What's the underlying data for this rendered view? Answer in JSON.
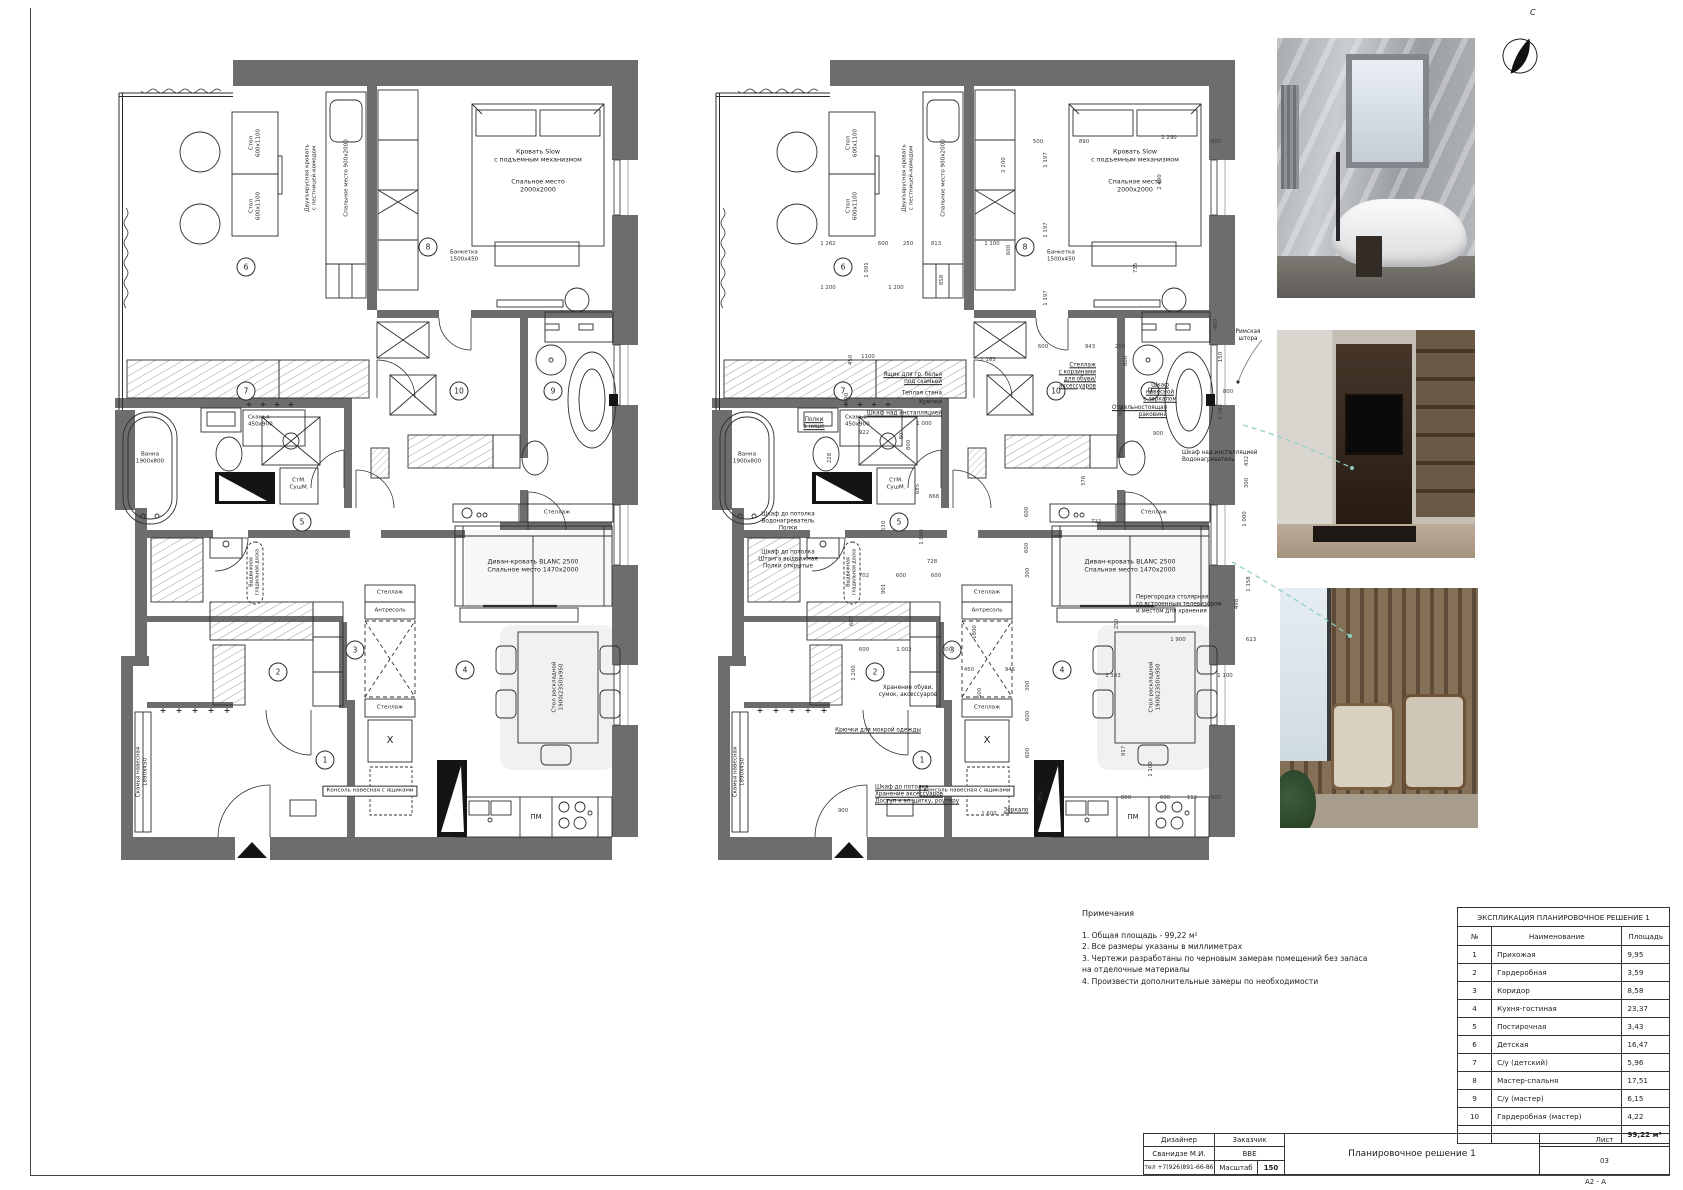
{
  "sheet": {
    "north_letter": "С",
    "format_label": "A2 - A"
  },
  "notes": {
    "title": "Примечания",
    "lines": [
      "1. Общая площадь - 99,22 м²",
      "2. Все размеры указаны в миллиметрах",
      "3. Чертежи разработаны по черновым замерам помещений без запаса",
      "на отделочные материалы",
      "4. Произвести дополнительные замеры по необходимости"
    ]
  },
  "legend": {
    "title": "ЭКСПЛИКАЦИЯ ПЛАНИРОВОЧНОЕ РЕШЕНИЕ 1",
    "col_num": "№",
    "col_name": "Наименование",
    "col_area": "Площадь",
    "rows": [
      {
        "num": "1",
        "name": "Прихожая",
        "area": "9,95"
      },
      {
        "num": "2",
        "name": "Гардеробная",
        "area": "3,59"
      },
      {
        "num": "3",
        "name": "Коридор",
        "area": "8,58"
      },
      {
        "num": "4",
        "name": "Кухня-гостиная",
        "area": "23,37"
      },
      {
        "num": "5",
        "name": "Постирочная",
        "area": "3,43"
      },
      {
        "num": "6",
        "name": "Детская",
        "area": "16,47"
      },
      {
        "num": "7",
        "name": "С/у (детский)",
        "area": "5,96"
      },
      {
        "num": "8",
        "name": "Мастер-спальня",
        "area": "17,51"
      },
      {
        "num": "9",
        "name": "С/у (мастер)",
        "area": "6,15"
      },
      {
        "num": "10",
        "name": "Гардеробная (мастер)",
        "area": "4,22"
      }
    ],
    "total": "99,22 м²"
  },
  "title_block": {
    "designer_label": "Дизайнер",
    "designer": "Сванидзе М.И.",
    "phone": "тел +7(926)891-66-86",
    "client_label": "Заказчик",
    "client": "ВВЕ",
    "scale_label": "Масштаб",
    "scale": "150",
    "title": "Планировочное решение 1",
    "sheet_label": "Лист",
    "sheet_num": "03"
  },
  "plan": {
    "common": [
      {
        "t": "Стол\n600х1100",
        "x": 140,
        "y": 83,
        "c": "v t5"
      },
      {
        "t": "Стол\n600х1100",
        "x": 140,
        "y": 146,
        "c": "v t5"
      },
      {
        "t": "Двухъярусная кровать\nс лестницей-комодом",
        "x": 196,
        "y": 118,
        "c": "v t5"
      },
      {
        "t": "Спальное место 900х2000",
        "x": 232,
        "y": 118,
        "c": "v t5"
      },
      {
        "t": "Кровать Slow\nс подъемным механизмом",
        "x": 423,
        "y": 96,
        "c": ""
      },
      {
        "t": "Спальное место\n2000х2000",
        "x": 423,
        "y": 126,
        "c": ""
      },
      {
        "t": "Банкетка\n1500х450",
        "x": 335,
        "y": 196,
        "c": "la t5"
      },
      {
        "t": "Ванна\n1900х800",
        "x": 35,
        "y": 398,
        "c": "t5"
      },
      {
        "t": "Скамья\n450х900",
        "x": 133,
        "y": 361,
        "c": "la t5"
      },
      {
        "t": "СтМ.\nСушМ.",
        "x": 184,
        "y": 424,
        "c": "t5"
      },
      {
        "t": "Диван-кровать BLANC 2500\nСпальное место 1470х2000",
        "x": 418,
        "y": 506,
        "c": ""
      },
      {
        "t": "Стеллаж",
        "x": 442,
        "y": 453,
        "c": "t5"
      },
      {
        "t": "Стеллаж",
        "x": 275,
        "y": 533,
        "c": "t5"
      },
      {
        "t": "Антресоль",
        "x": 275,
        "y": 551,
        "c": "t5"
      },
      {
        "t": "Стеллаж",
        "x": 275,
        "y": 648,
        "c": "t5"
      },
      {
        "t": "X",
        "x": 275,
        "y": 681,
        "c": "big"
      },
      {
        "t": "Стол раскладной\n1900(2350)х950",
        "x": 443,
        "y": 627,
        "c": "v t5"
      },
      {
        "t": "Консоль навесная с ящиками",
        "x": 255,
        "y": 731,
        "c": "box"
      },
      {
        "t": "Скамья навесная\n1890х450",
        "x": 27,
        "y": 712,
        "c": "v t5"
      },
      {
        "t": "ПМ",
        "x": 421,
        "y": 757,
        "c": "t6"
      },
      {
        "t": "Выдвижная\nгладильная доска",
        "x": 140,
        "y": 512,
        "c": "v t4"
      },
      {
        "t": "1",
        "x": 210,
        "y": 700,
        "c": "circle"
      },
      {
        "t": "2",
        "x": 163,
        "y": 612,
        "c": "circle"
      },
      {
        "t": "3",
        "x": 240,
        "y": 590,
        "c": "circle"
      },
      {
        "t": "4",
        "x": 350,
        "y": 610,
        "c": "circle"
      },
      {
        "t": "5",
        "x": 187,
        "y": 462,
        "c": "circle"
      },
      {
        "t": "6",
        "x": 131,
        "y": 207,
        "c": "circle"
      },
      {
        "t": "7",
        "x": 131,
        "y": 331,
        "c": "circle"
      },
      {
        "t": "8",
        "x": 313,
        "y": 187,
        "c": "circle"
      },
      {
        "t": "9",
        "x": 438,
        "y": 331,
        "c": "circle"
      },
      {
        "t": "10",
        "x": 344,
        "y": 331,
        "c": "circle"
      }
    ],
    "right_ann": [
      {
        "t": "Римская штора",
        "x": 536,
        "y": 276,
        "c": "ann"
      },
      {
        "t": "Ящик для гр. белья\nпод скамьей",
        "x": 230,
        "y": 319,
        "c": "ann ra ul"
      },
      {
        "t": "Теплая стена",
        "x": 230,
        "y": 334,
        "c": "ann ra"
      },
      {
        "t": "Крючки",
        "x": 230,
        "y": 343,
        "c": "ann ra"
      },
      {
        "t": "Шкаф над инсталляцией",
        "x": 230,
        "y": 354,
        "c": "ann ra ul"
      },
      {
        "t": "Полки\nв нише",
        "x": 102,
        "y": 364,
        "c": "ann ul"
      },
      {
        "t": "Шкаф до потолка\nВодонагреватель\nПолки",
        "x": 76,
        "y": 462,
        "c": "ann"
      },
      {
        "t": "Шкаф до потолка\nШтанга выдвижная\nПолки открытые",
        "x": 76,
        "y": 500,
        "c": "ann"
      },
      {
        "t": "Стеллаж\nс корзинами\nдля обуви/\nаксессуаров",
        "x": 384,
        "y": 316,
        "c": "ann ra ul"
      },
      {
        "t": "Шкаф\nнавесной\nс зеркалом",
        "x": 448,
        "y": 333,
        "c": "ann ul"
      },
      {
        "t": "Отдельностоящая\nраковина",
        "x": 455,
        "y": 352,
        "c": "ann ra ul"
      },
      {
        "t": "Шкаф над инсталляцией\nВодонагреватель",
        "x": 470,
        "y": 397,
        "c": "ann la"
      },
      {
        "t": "Перегородка столярная\nсо встроенным телевизором\nи местом для хранения",
        "x": 424,
        "y": 545,
        "c": "ann la"
      },
      {
        "t": "Хранение обуви,\nсумок, аксессуаров",
        "x": 196,
        "y": 632,
        "c": "ann"
      },
      {
        "t": "Крючки для мокрой одежды",
        "x": 166,
        "y": 671,
        "c": "ann ul"
      },
      {
        "t": "Шкаф до потолка\nХранение аксессуаров\nДоступ к эл.щитку, роутеру",
        "x": 163,
        "y": 735,
        "c": "ann la ul"
      },
      {
        "t": "Зеркало",
        "x": 304,
        "y": 751,
        "c": "ann ul"
      }
    ],
    "right_dims": [
      {
        "t": "500",
        "x": 326,
        "y": 82,
        "c": "dim"
      },
      {
        "t": "890",
        "x": 372,
        "y": 82,
        "c": "dim"
      },
      {
        "t": "2 290",
        "x": 457,
        "y": 78,
        "c": "dim"
      },
      {
        "t": "600",
        "x": 504,
        "y": 82,
        "c": "dim"
      },
      {
        "t": "1 262",
        "x": 116,
        "y": 184,
        "c": "dim"
      },
      {
        "t": "600",
        "x": 171,
        "y": 184,
        "c": "dim"
      },
      {
        "t": "250",
        "x": 196,
        "y": 184,
        "c": "dim"
      },
      {
        "t": "813",
        "x": 224,
        "y": 184,
        "c": "dim"
      },
      {
        "t": "1 100",
        "x": 280,
        "y": 184,
        "c": "dim"
      },
      {
        "t": "600",
        "x": 297,
        "y": 190,
        "c": "dim v"
      },
      {
        "t": "1 091",
        "x": 155,
        "y": 210,
        "c": "dim v"
      },
      {
        "t": "1 200",
        "x": 116,
        "y": 228,
        "c": "dim"
      },
      {
        "t": "1 200",
        "x": 184,
        "y": 228,
        "c": "dim"
      },
      {
        "t": "858",
        "x": 230,
        "y": 220,
        "c": "dim v"
      },
      {
        "t": "1 197",
        "x": 334,
        "y": 100,
        "c": "dim v"
      },
      {
        "t": "1 197",
        "x": 334,
        "y": 170,
        "c": "dim v"
      },
      {
        "t": "1 197",
        "x": 334,
        "y": 238,
        "c": "dim v"
      },
      {
        "t": "2 200",
        "x": 292,
        "y": 105,
        "c": "dim v"
      },
      {
        "t": "2 490",
        "x": 448,
        "y": 122,
        "c": "dim v"
      },
      {
        "t": "735",
        "x": 424,
        "y": 208,
        "c": "dim v"
      },
      {
        "t": "450",
        "x": 139,
        "y": 300,
        "c": "dim v"
      },
      {
        "t": "1100",
        "x": 156,
        "y": 297,
        "c": "dim"
      },
      {
        "t": "890",
        "x": 135,
        "y": 338,
        "c": "dim v"
      },
      {
        "t": "922",
        "x": 152,
        "y": 373,
        "c": "dim"
      },
      {
        "t": "228",
        "x": 118,
        "y": 398,
        "c": "dim v"
      },
      {
        "t": "1 163",
        "x": 276,
        "y": 300,
        "c": "dim"
      },
      {
        "t": "1 000",
        "x": 212,
        "y": 364,
        "c": "dim"
      },
      {
        "t": "80",
        "x": 190,
        "y": 376,
        "c": "dim v"
      },
      {
        "t": "800",
        "x": 197,
        "y": 385,
        "c": "dim v"
      },
      {
        "t": "685",
        "x": 206,
        "y": 429,
        "c": "dim v"
      },
      {
        "t": "668",
        "x": 222,
        "y": 437,
        "c": "dim"
      },
      {
        "t": "530",
        "x": 172,
        "y": 466,
        "c": "dim v"
      },
      {
        "t": "1 060",
        "x": 210,
        "y": 477,
        "c": "dim v"
      },
      {
        "t": "600",
        "x": 315,
        "y": 452,
        "c": "dim v"
      },
      {
        "t": "600",
        "x": 315,
        "y": 488,
        "c": "dim v"
      },
      {
        "t": "600",
        "x": 331,
        "y": 287,
        "c": "dim"
      },
      {
        "t": "943",
        "x": 378,
        "y": 287,
        "c": "dim"
      },
      {
        "t": "250",
        "x": 408,
        "y": 287,
        "c": "dim"
      },
      {
        "t": "800",
        "x": 414,
        "y": 301,
        "c": "dim v"
      },
      {
        "t": "938",
        "x": 409,
        "y": 351,
        "c": "dim v"
      },
      {
        "t": "900",
        "x": 446,
        "y": 374,
        "c": "dim"
      },
      {
        "t": "600",
        "x": 410,
        "y": 392,
        "c": "dim v"
      },
      {
        "t": "376",
        "x": 372,
        "y": 421,
        "c": "dim v"
      },
      {
        "t": "722",
        "x": 384,
        "y": 462,
        "c": "dim"
      },
      {
        "t": "400",
        "x": 504,
        "y": 264,
        "c": "dim v"
      },
      {
        "t": "800",
        "x": 516,
        "y": 332,
        "c": "dim"
      },
      {
        "t": "150",
        "x": 509,
        "y": 297,
        "c": "dim v"
      },
      {
        "t": "1 700",
        "x": 509,
        "y": 352,
        "c": "dim v"
      },
      {
        "t": "432",
        "x": 535,
        "y": 401,
        "c": "dim v"
      },
      {
        "t": "300",
        "x": 535,
        "y": 423,
        "c": "dim v"
      },
      {
        "t": "1 000",
        "x": 533,
        "y": 459,
        "c": "dim v"
      },
      {
        "t": "1 158",
        "x": 537,
        "y": 524,
        "c": "dim v"
      },
      {
        "t": "498",
        "x": 525,
        "y": 544,
        "c": "dim v"
      },
      {
        "t": "250",
        "x": 405,
        "y": 564,
        "c": "dim v"
      },
      {
        "t": "1 900",
        "x": 466,
        "y": 580,
        "c": "dim"
      },
      {
        "t": "623",
        "x": 539,
        "y": 580,
        "c": "dim"
      },
      {
        "t": "1 383",
        "x": 401,
        "y": 616,
        "c": "dim"
      },
      {
        "t": "1 100",
        "x": 513,
        "y": 616,
        "c": "dim"
      },
      {
        "t": "728",
        "x": 220,
        "y": 502,
        "c": "dim"
      },
      {
        "t": "702",
        "x": 152,
        "y": 516,
        "c": "dim"
      },
      {
        "t": "901",
        "x": 172,
        "y": 529,
        "c": "dim v"
      },
      {
        "t": "600",
        "x": 189,
        "y": 516,
        "c": "dim"
      },
      {
        "t": "600",
        "x": 224,
        "y": 516,
        "c": "dim"
      },
      {
        "t": "687",
        "x": 140,
        "y": 561,
        "c": "dim v"
      },
      {
        "t": "1800",
        "x": 263,
        "y": 572,
        "c": "dim v"
      },
      {
        "t": "600",
        "x": 152,
        "y": 590,
        "c": "dim"
      },
      {
        "t": "1 002",
        "x": 192,
        "y": 590,
        "c": "dim"
      },
      {
        "t": "300",
        "x": 235,
        "y": 590,
        "c": "dim"
      },
      {
        "t": "1 200",
        "x": 142,
        "y": 613,
        "c": "dim v"
      },
      {
        "t": "450",
        "x": 257,
        "y": 610,
        "c": "dim"
      },
      {
        "t": "945",
        "x": 298,
        "y": 610,
        "c": "dim"
      },
      {
        "t": "300",
        "x": 316,
        "y": 513,
        "c": "dim v"
      },
      {
        "t": "300",
        "x": 316,
        "y": 626,
        "c": "dim v"
      },
      {
        "t": "500",
        "x": 268,
        "y": 633,
        "c": "dim v"
      },
      {
        "t": "600",
        "x": 316,
        "y": 656,
        "c": "dim v"
      },
      {
        "t": "600",
        "x": 316,
        "y": 693,
        "c": "dim v"
      },
      {
        "t": "900",
        "x": 131,
        "y": 751,
        "c": "dim"
      },
      {
        "t": "1 600",
        "x": 277,
        "y": 754,
        "c": "dim"
      },
      {
        "t": "852",
        "x": 329,
        "y": 736,
        "c": "dim v"
      },
      {
        "t": "800",
        "x": 414,
        "y": 738,
        "c": "dim"
      },
      {
        "t": "600",
        "x": 453,
        "y": 738,
        "c": "dim"
      },
      {
        "t": "917",
        "x": 412,
        "y": 691,
        "c": "dim v"
      },
      {
        "t": "1 100",
        "x": 439,
        "y": 709,
        "c": "dim v"
      },
      {
        "t": "112",
        "x": 480,
        "y": 738,
        "c": "dim"
      },
      {
        "t": "600",
        "x": 504,
        "y": 738,
        "c": "dim"
      }
    ]
  }
}
